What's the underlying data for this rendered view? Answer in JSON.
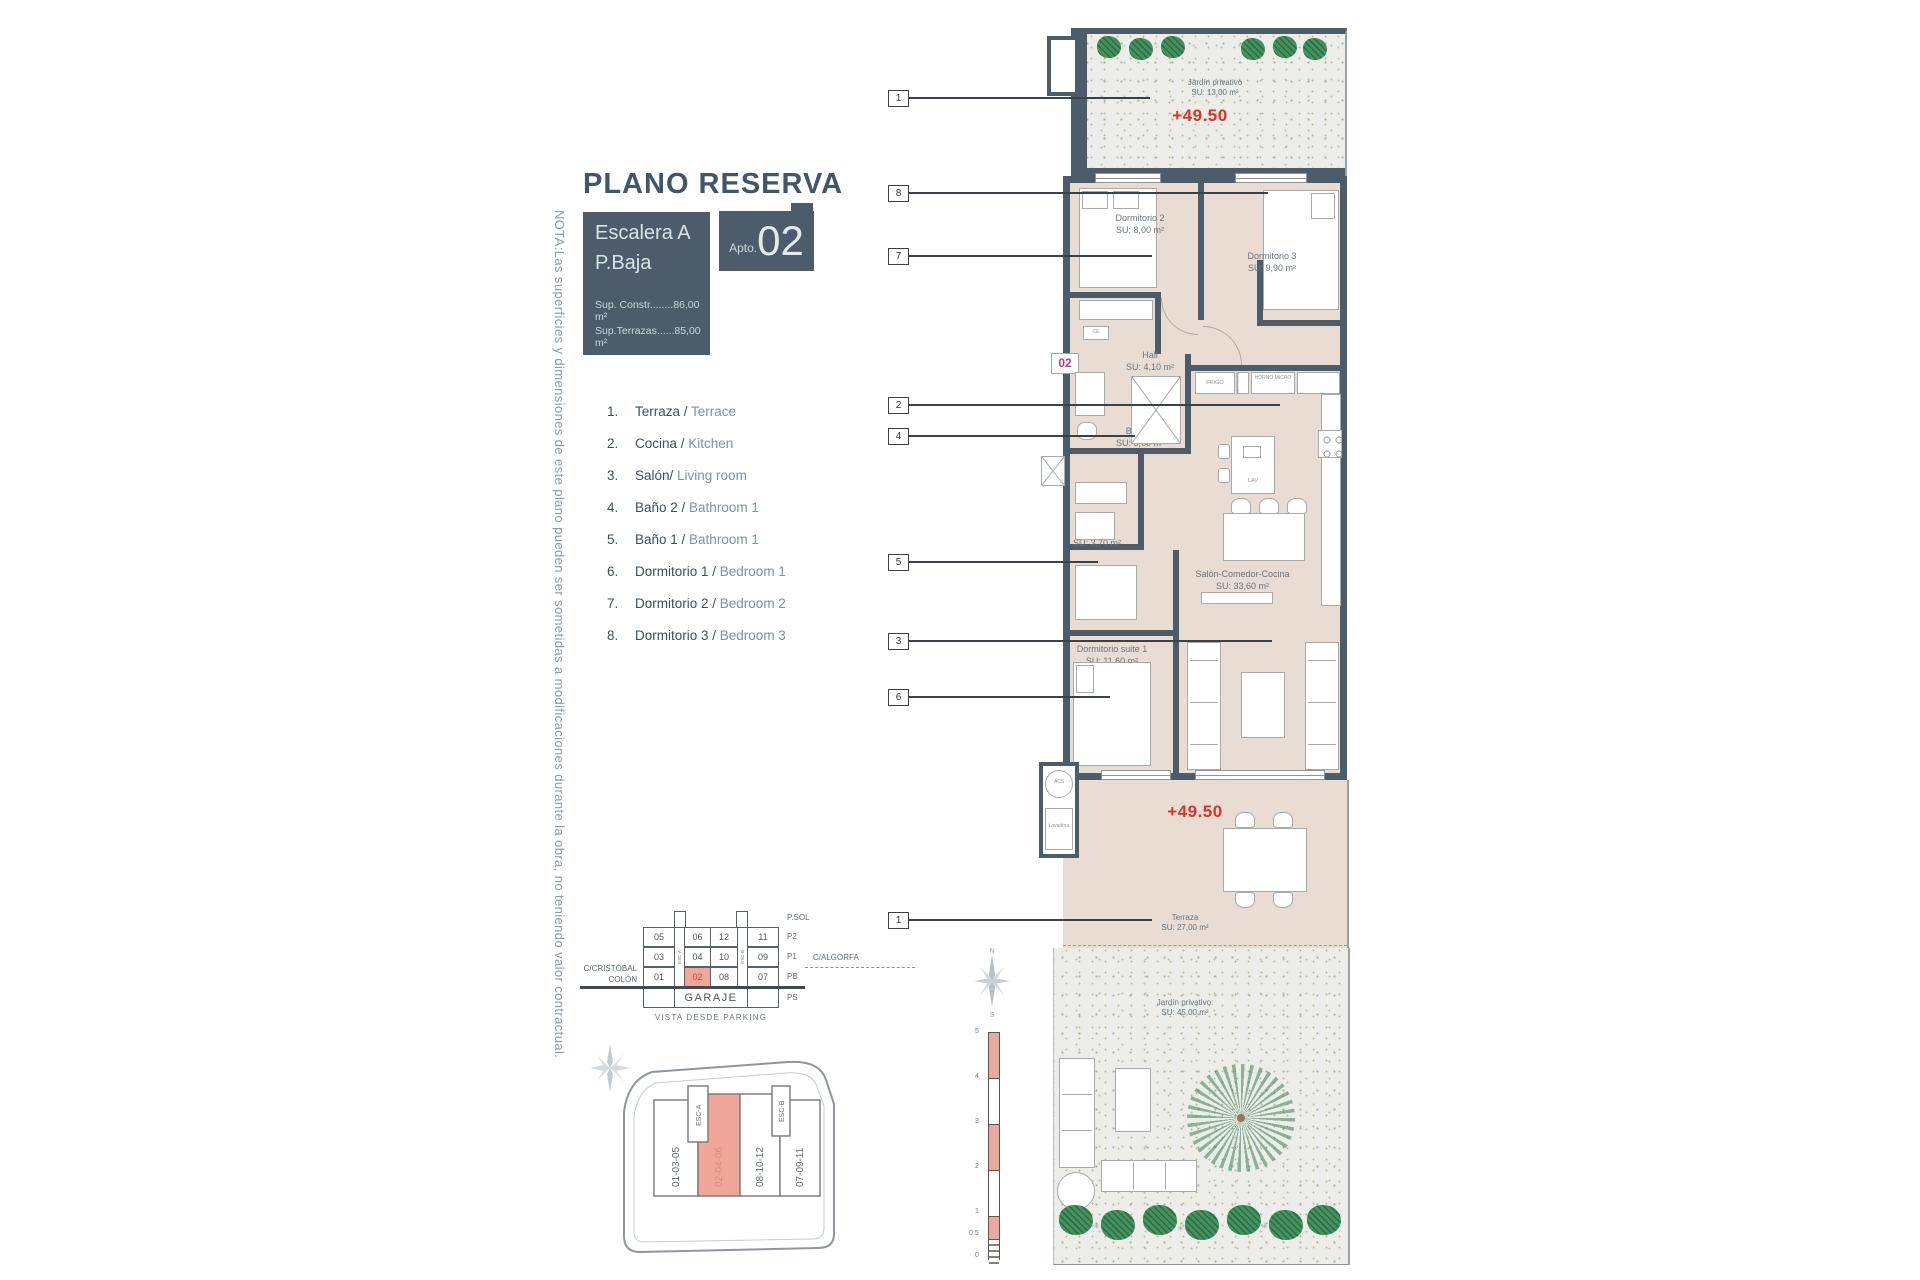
{
  "title": "PLANO RESERVA",
  "unit_box": {
    "escalera": "Escalera A",
    "planta": "P.Baja",
    "sup_constr": "Sup. Constr........86,00 m²",
    "sup_terrazas": "Sup.Terrazas......85,00 m²",
    "apto_label": "Apto.",
    "apto_number": "02"
  },
  "note": "NOTA:Las superficies y dimensiones de este plano pueden ser sometidas a modificaciones durante la obra, no teniendo valor contractual.",
  "legend": {
    "items": [
      {
        "num": "1.",
        "es": "Terraza / ",
        "en": "Terrace"
      },
      {
        "num": "2.",
        "es": "Cocina / ",
        "en": "Kitchen"
      },
      {
        "num": "3.",
        "es": "Salón/ ",
        "en": "Living room"
      },
      {
        "num": "4.",
        "es": "Baño 2 / ",
        "en": "Bathroom 1"
      },
      {
        "num": "5.",
        "es": "Baño 1 / ",
        "en": "Bathroom 1"
      },
      {
        "num": "6.",
        "es": "Dormitorio 1 / ",
        "en": "Bedroom 1"
      },
      {
        "num": "7.",
        "es": "Dormitorio 2 / ",
        "en": "Bedroom 2"
      },
      {
        "num": "8.",
        "es": "Dormitorio 3 / ",
        "en": "Bedroom 3"
      }
    ]
  },
  "callouts": [
    "1",
    "8",
    "7",
    "2",
    "4",
    "5",
    "3",
    "6",
    "1"
  ],
  "plan": {
    "garden_top": {
      "name": "Jardín privativo",
      "area": "SU: 13,00 m²",
      "elevation": "+49.50"
    },
    "rooms": {
      "dorm2": {
        "name": "Dormitorio 2",
        "area": "SU: 8,00 m²"
      },
      "dorm3": {
        "name": "Dormitorio 3",
        "area": "SU: 9,90 m²"
      },
      "hall": {
        "name": "Hall",
        "area": "SU: 4,10 m²"
      },
      "bano2": {
        "name": "Baño 2",
        "area": "SU: 3,60 m²"
      },
      "bano1": {
        "name": "Baño 1",
        "area": "SU: 3,70 m²"
      },
      "salon": {
        "name": "Salón-Comedor-Cocina",
        "area": "SU: 33,60 m²"
      },
      "suite": {
        "name": "Dormitorio suite 1",
        "area": "SU: 11,60 m²"
      },
      "terraza": {
        "name": "Terraza",
        "area": "SU: 27,00 m²",
        "elevation": "+49.50"
      },
      "garden": {
        "name": "Jardín privativo:",
        "area": "SU: 45,00 m²"
      }
    },
    "unit_badge": "02",
    "fixtures": {
      "frigo": "FRIGO",
      "botellero": "BOTELLERO",
      "horno_micro": "HORNO MICRO",
      "lav": "LAV",
      "ce": "CE",
      "acs": "ACS",
      "lavadora": "Lavadora"
    },
    "scalebar": [
      "5",
      "4",
      "3",
      "2",
      "1",
      "0.5",
      "0"
    ],
    "compass": {
      "north": "N",
      "south": "S"
    }
  },
  "garage": {
    "row_labels": [
      "P.SOL",
      "P2",
      "P1",
      "PB",
      "PS"
    ],
    "cols": {
      "a": [
        "05",
        "03",
        "01"
      ],
      "b": [
        "06",
        "04",
        "02"
      ],
      "c": [
        "12",
        "10",
        "08"
      ],
      "d": [
        "11",
        "09",
        "07"
      ]
    },
    "stair_left": "ESC-A",
    "stair_right": "ESC-B",
    "garaje": "GARAJE",
    "street_left_1": "C/CRISTÓBAL",
    "street_left_2": "COLÓN",
    "street_right": "C/ALGORFA",
    "caption": "VISTA DESDE PARKING"
  },
  "siteplan": {
    "strips": [
      "01-03-05",
      "02-04-06",
      "08-10-12",
      "07-09-11"
    ],
    "stair_a": "ESC-A",
    "stair_b": "ESC-B"
  },
  "colors": {
    "accent_red": "#dd3327",
    "magenta": "#b23a98",
    "slate": "#4c5c6a",
    "salmon": "#f0a79a"
  }
}
